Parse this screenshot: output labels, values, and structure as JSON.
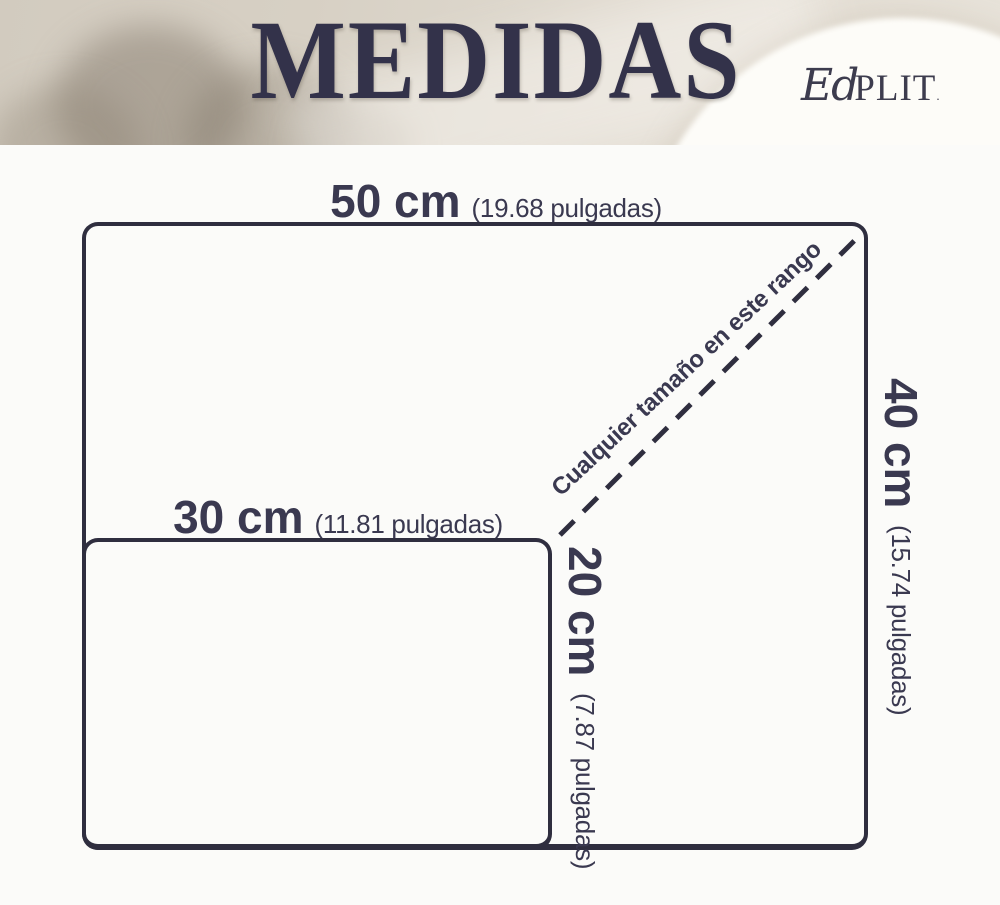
{
  "header": {
    "title": "MEDIDAS",
    "brand_script": "Ed",
    "brand_serif": "PLIT",
    "brand_mark": "."
  },
  "diagram": {
    "large_rect": {
      "width_cm": "50 cm",
      "width_inches": "(19.68 pulgadas)",
      "height_cm": "40 cm",
      "height_inches": "(15.74 pulgadas)"
    },
    "small_rect": {
      "width_cm": "30 cm",
      "width_inches": "(11.81 pulgadas)",
      "height_cm": "20 cm",
      "height_inches": "(7.87 pulgadas)"
    },
    "diagonal_note": "Cualquier tamaño en este rango"
  },
  "colors": {
    "ink": "#3a3950",
    "line": "#2f2e3f",
    "canvas_background": "#fbfbf9",
    "header_beige": "#d7d0c4"
  }
}
